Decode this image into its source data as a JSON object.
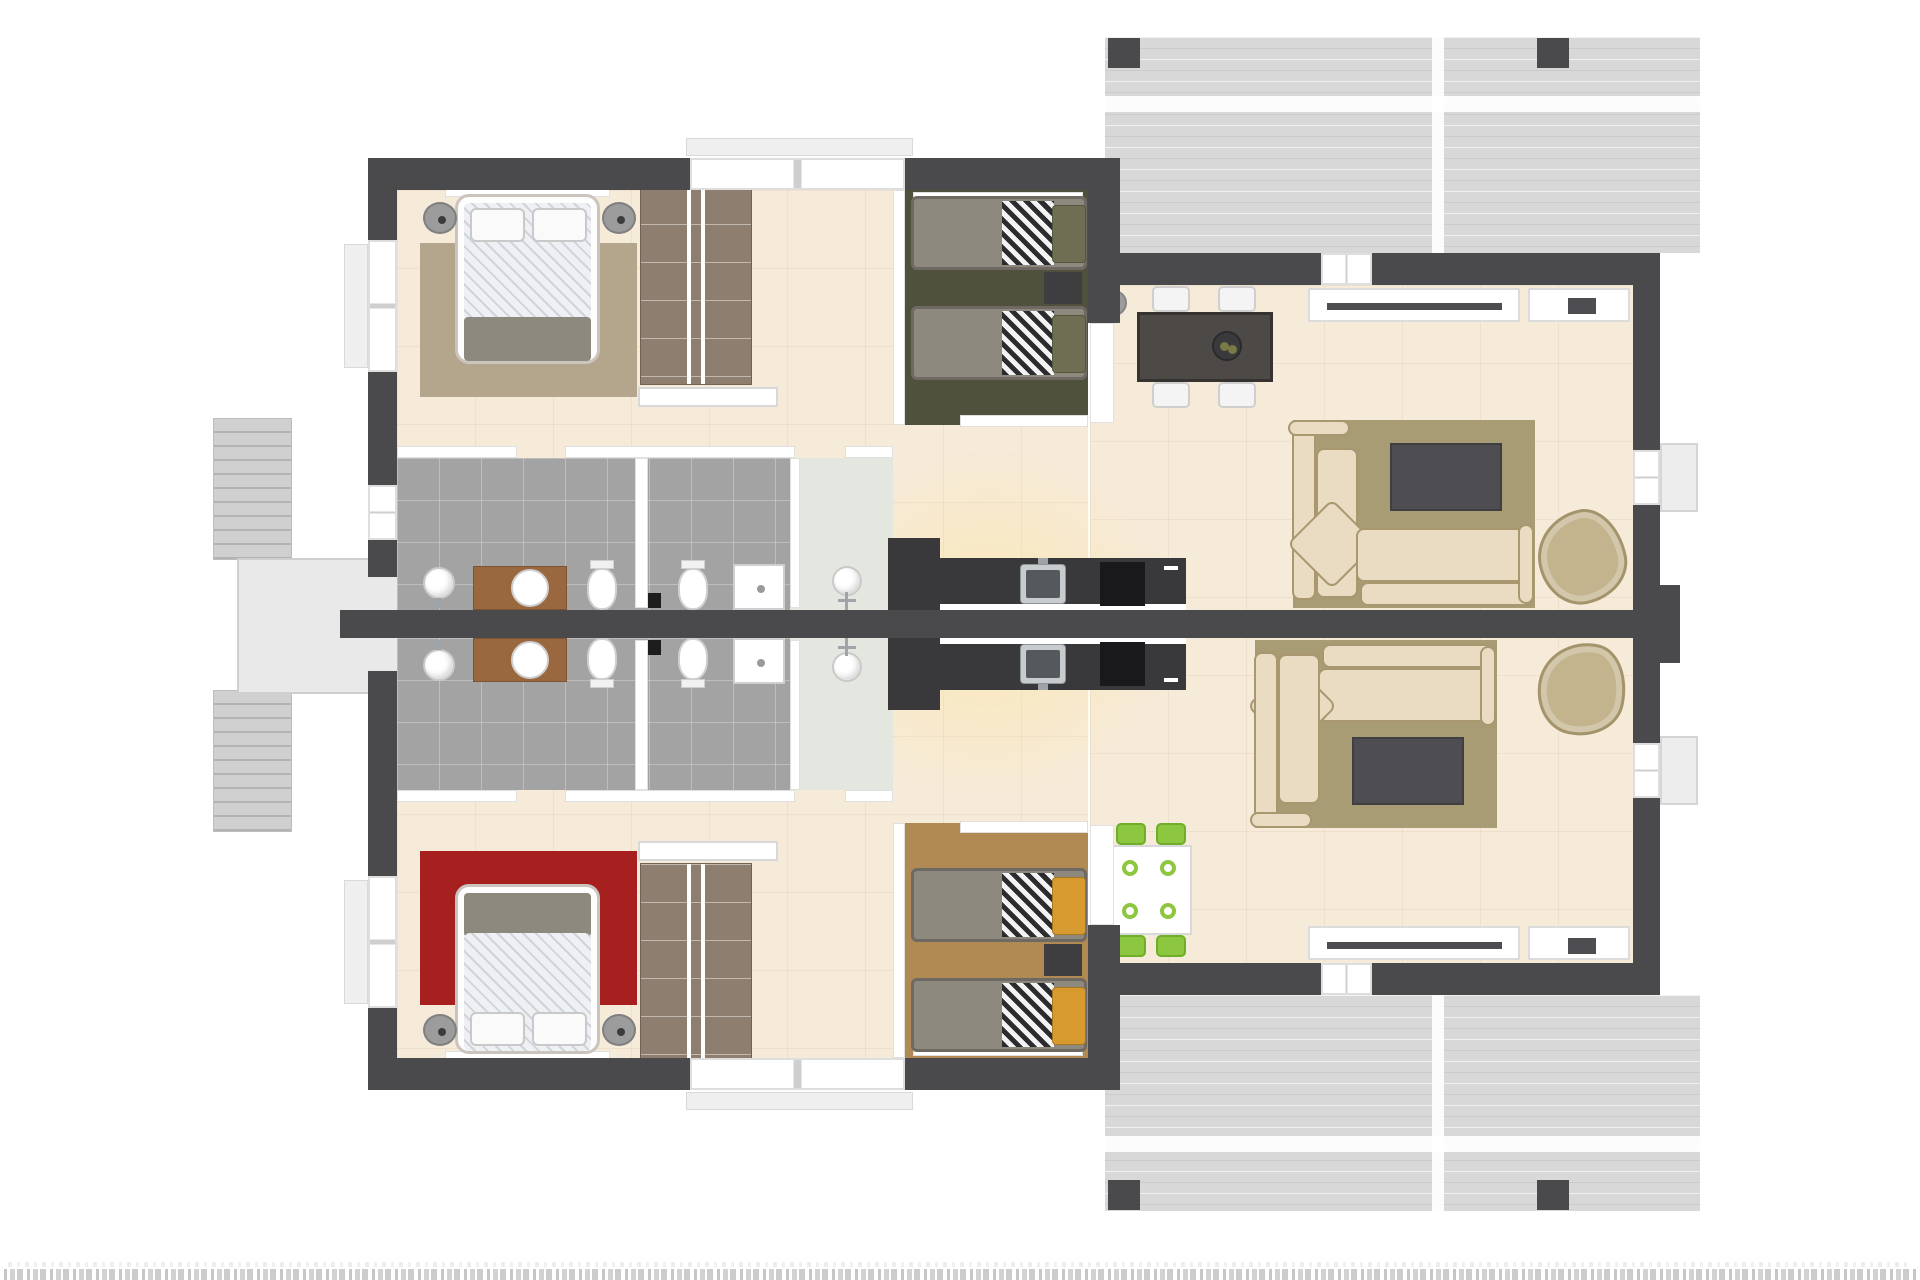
{
  "meta": {
    "type": "3d-floor-plan-render",
    "description": "Top-down 3D rendered floor plan of a mirrored two-unit duplex apartment with shared entry stair, terraces right, bedrooms left, bathrooms center, open kitchen-living-dining right",
    "units": 2,
    "watermark_caption": {
      "visible": true,
      "readable": false,
      "note": "text strip cropped at bottom edge of image"
    }
  },
  "colors": {
    "wall": "#4a4a4d",
    "floor": "#f6ead9",
    "bath": "#a3a3a3",
    "shower": "#e4e7df",
    "terrace": "#d8d8d8",
    "stairs": "#d0d0d0",
    "porch": "#e9e9e9",
    "rugTan": "#b4a58d",
    "rugRed": "#a6201f",
    "rugKhaki": "#a89c74",
    "oliveRoom": "#50513c",
    "amberRoom": "#b08a52",
    "sofaCream": "#e9dcc3",
    "sofaBorder": "#a8976f",
    "lounge": "#c3b48e",
    "tvUnit": "#4e4e52",
    "wardrobe": "#8e7e6f",
    "vanity": "#99683f",
    "counter": "#39393c",
    "steel": "#c9ccce",
    "cooktop": "#19191c",
    "tableDark": "#4c4947",
    "chairWhite": "#f4f4f4",
    "chairGreen": "#8dc63f",
    "stripeDark": "#2c2c2f",
    "pillowOlive": "#6e6e52",
    "pillowAmber": "#d79a2f",
    "blanket": "#8e897f",
    "nightstand": "#9c9c9c",
    "nightstandDark": "#3e3e41"
  },
  "stairs": {
    "flights": 2,
    "steps_per_flight": 10,
    "shared_entry_porch": true
  },
  "unit_a": {
    "position": "upper",
    "rooms": [
      "double-bedroom",
      "wardrobe-closet",
      "twin-bedroom-olive",
      "bathroom",
      "shower-room",
      "hallway",
      "kitchen",
      "dining-area",
      "living-room"
    ],
    "furniture": [
      "double-bed",
      "round-nightstand-x2",
      "tan-rug",
      "wardrobe",
      "console-shelf",
      "twin-bed-x2",
      "dark-nightstand",
      "vanity-round-basin",
      "toilet-x2",
      "shower-tray",
      "kitchen-counter-sink-cooktop",
      "dining-table-dark",
      "white-chair-x4",
      "fruit-bowl",
      "sideboard",
      "corner-sofa",
      "tv-table",
      "lounge-chair",
      "khaki-rug"
    ]
  },
  "unit_b": {
    "position": "lower",
    "rooms": [
      "double-bedroom-red-rug",
      "wardrobe-closet",
      "twin-bedroom-amber",
      "bathroom",
      "shower-room",
      "hallway",
      "kitchen",
      "dining-area",
      "living-room"
    ],
    "furniture": [
      "double-bed",
      "round-nightstand-x2",
      "red-rug",
      "wardrobe",
      "console-shelf",
      "twin-bed-x2",
      "dark-nightstand",
      "vanity-round-basin",
      "toilet-x2",
      "shower-tray",
      "kitchen-counter-sink-cooktop",
      "dining-table-white",
      "green-chair-x4",
      "sideboard",
      "corner-sofa",
      "tv-table",
      "lounge-chair",
      "khaki-rug"
    ]
  },
  "exterior": [
    "upper-terrace-deck",
    "lower-terrace-deck",
    "deck-posts",
    "entry-stair-two-flights",
    "entry-porch",
    "balcony-pad-x2"
  ]
}
